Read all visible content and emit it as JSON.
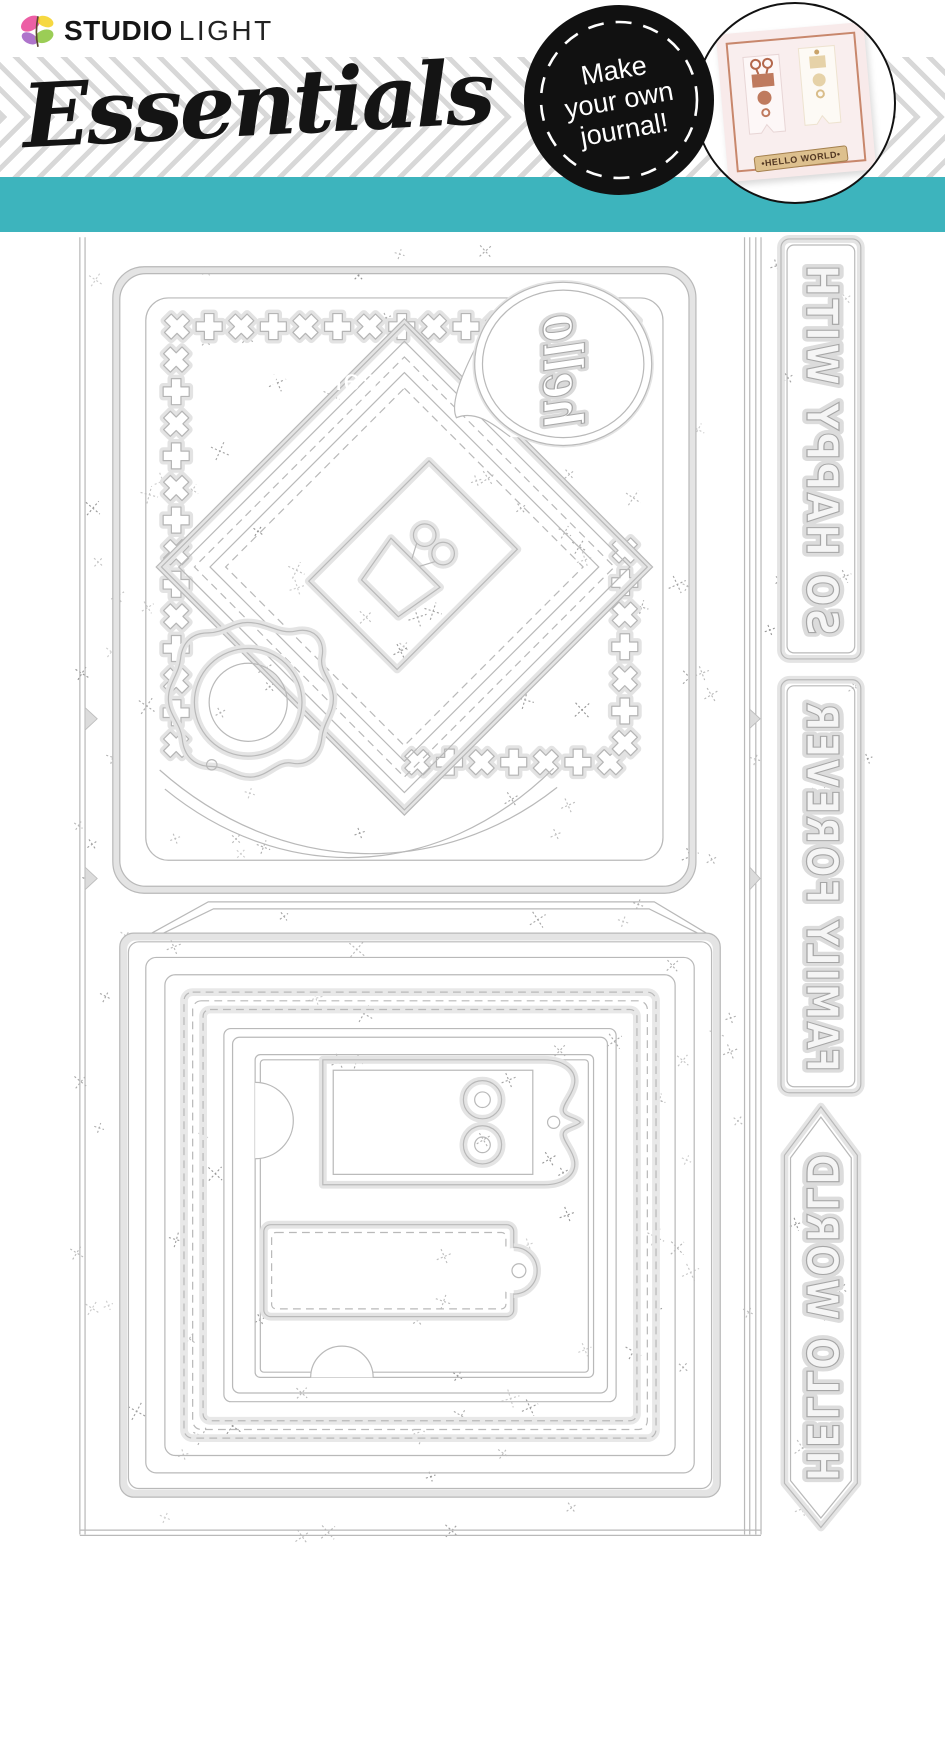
{
  "header": {
    "logo": {
      "bold": "STUDIO",
      "light": "LIGHT"
    },
    "series_title": "Essentials",
    "banner_label": "Cutting dies",
    "badge": {
      "line1": "Make",
      "line2": "your own",
      "line3": "journal!"
    },
    "sample_card_label": "•HELLO WORLD•"
  },
  "sheet": {
    "script_word": "hello",
    "word_dies": [
      {
        "text": "SO HAPPY WITH",
        "shape": "rounded-rectangle-strip"
      },
      {
        "text": "FAMILY FOREVER",
        "shape": "rounded-rectangle-strip"
      },
      {
        "text": "HELLO WORLD",
        "shape": "double-pointed-banner"
      }
    ],
    "shape_dies": [
      "square-card-with-cross-stitch-border",
      "stitched-diamond-nesting-frames",
      "binder-clip-tag",
      "hello-speech-bubble",
      "scalloped-circle-frames",
      "pocket-with-flap-and-stitched-frames",
      "double-eyelet-ticket-tag",
      "stitched-luggage-tag",
      "edge-release-notches"
    ]
  },
  "colors": {
    "teal_banner": "#3db4bd",
    "badge_bg": "#111111",
    "badge_text": "#ffffff",
    "stripe_gray": "#d8d8d8",
    "die_outline": "#b9b9b9",
    "die_halo": "#e4e4e4",
    "card_pink": "#f8eaea",
    "card_frame_copper": "#c8876c",
    "terracotta": "#bf7a5e",
    "cream": "#e6d2a8",
    "label_tan": "#ddc08e"
  }
}
